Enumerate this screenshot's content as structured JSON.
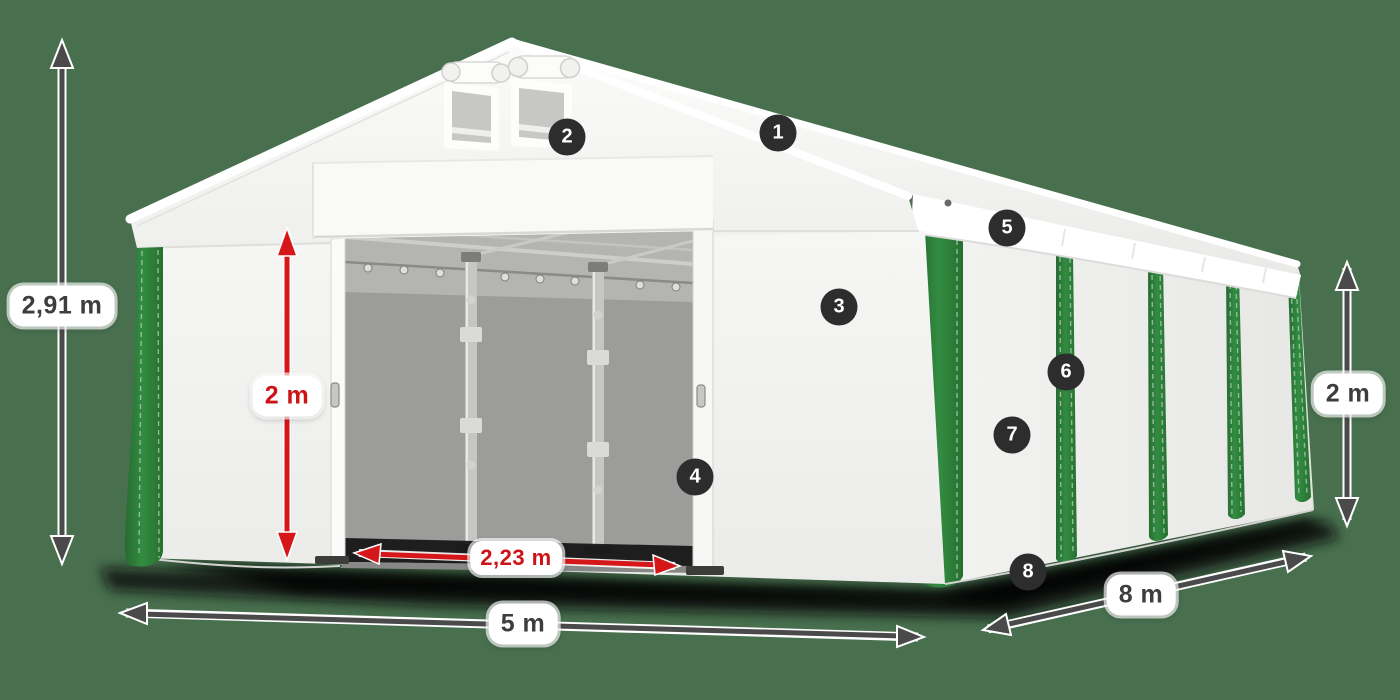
{
  "colors": {
    "background": "#48704f",
    "tent_white": "#f4f4f2",
    "stripe_green": "#2e7d3b",
    "dimension_arrow_gray": "#4a4a4a",
    "dimension_arrow_red": "#d6171a",
    "marker_background": "#2d2d2d",
    "marker_text": "#ffffff"
  },
  "measurements": {
    "total_height": "2,91 m",
    "door_height": "2 m",
    "door_width": "2,23 m",
    "front_width": "5 m",
    "side_length": "8 m",
    "wall_height": "2 m"
  },
  "markers": [
    "1",
    "2",
    "3",
    "4",
    "5",
    "6",
    "7",
    "8"
  ]
}
